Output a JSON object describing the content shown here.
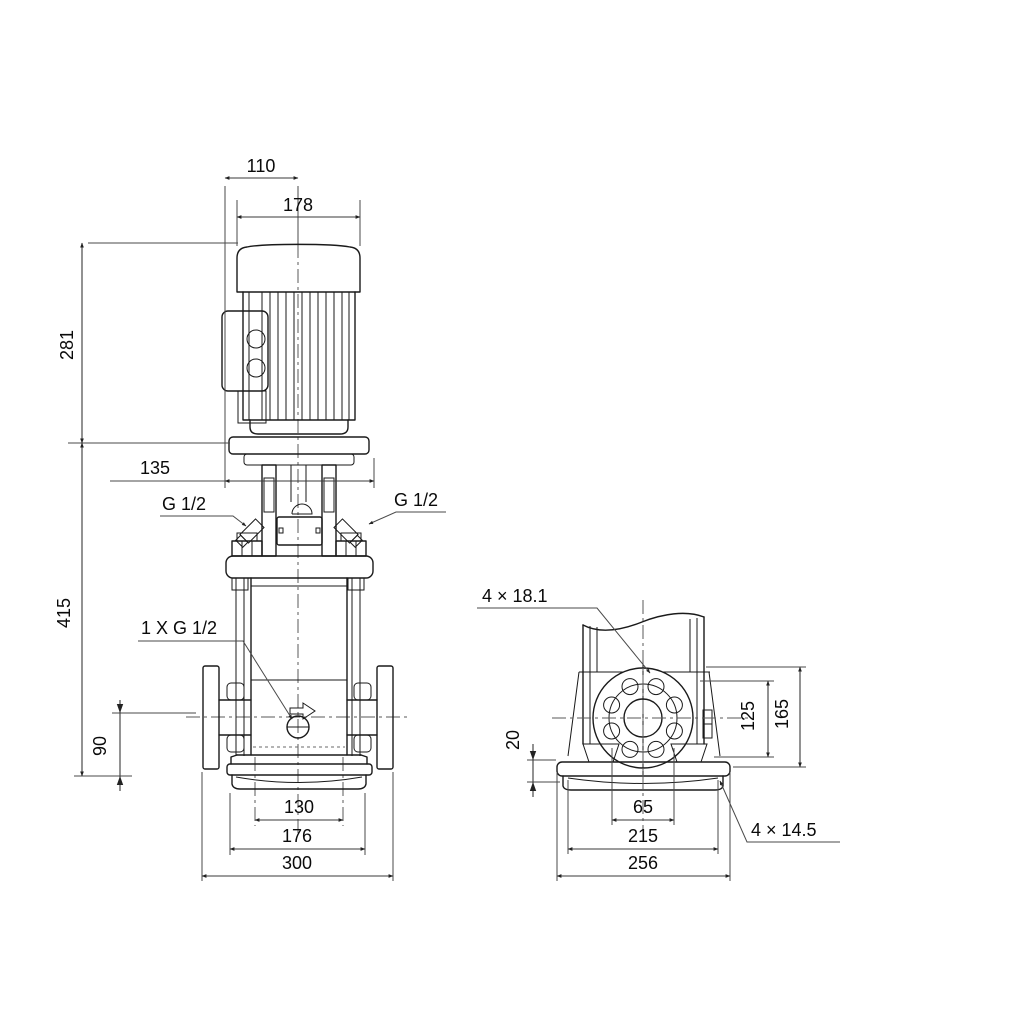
{
  "drawing": {
    "title": "pump-dimensional-drawing",
    "colors": {
      "background": "#ffffff",
      "line": "#1a1a1a",
      "dimension": "#3a3a3a"
    },
    "front_view": {
      "dim_motor_offset": "110",
      "dim_motor_width": "178",
      "dim_motor_height": "281",
      "dim_head_width": "135",
      "dim_total_height": "415",
      "dim_port_height": "90",
      "dim_base_bolt_spacing": "130",
      "dim_base_width": "176",
      "dim_port_to_port": "300",
      "label_vent_left": "G 1/2",
      "label_vent_right": "G 1/2",
      "label_drain_port": "1 X G 1/2"
    },
    "side_view": {
      "label_flange_holes": "4 × 18.1",
      "dim_bolt_circle": "125",
      "dim_flange_od": "165",
      "dim_baseplate_height": "20",
      "dim_base_hole_spacing": "65",
      "dim_base_bolt_span": "215",
      "dim_base_length": "256",
      "label_base_holes": "4 × 14.5"
    }
  }
}
